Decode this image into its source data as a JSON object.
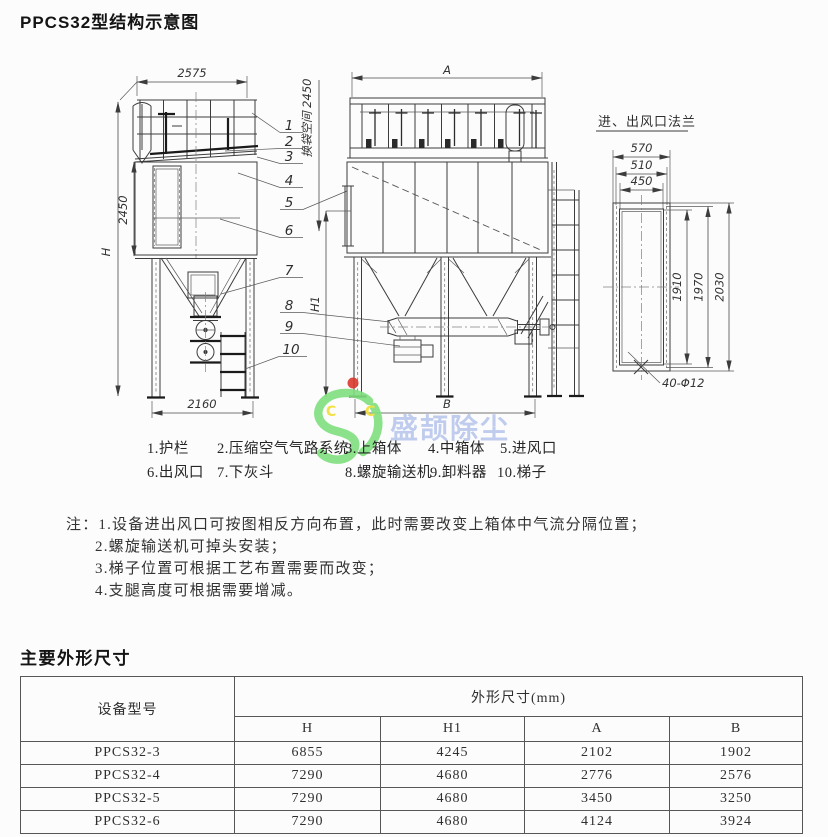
{
  "page": {
    "title": "PPCS32型结构示意图",
    "dims_section_title": "主要外形尺寸"
  },
  "diagram": {
    "side_view": {
      "width_top": "2575",
      "height_body": "2450",
      "height_total": "H",
      "width_base": "2160",
      "bag_space": "换袋空间 2450"
    },
    "front_view": {
      "width_top": "A",
      "width_base": "B",
      "height": "H1"
    },
    "flange_view": {
      "title": "进、出风口法兰",
      "w_outer": "570",
      "w_bolt": "510",
      "w_open": "450",
      "h_open": "1910",
      "h_bolt": "1970",
      "h_outer": "2030",
      "bolt_note": "40-Φ12"
    },
    "callouts": [
      "1",
      "2",
      "3",
      "4",
      "5",
      "6",
      "7",
      "8",
      "9",
      "10"
    ]
  },
  "legend": {
    "rows": [
      [
        "1.护栏",
        "2.压缩空气气路系统",
        "3.上箱体",
        "4.中箱体",
        "5.进风口"
      ],
      [
        "6.出风口",
        "7.下灰斗",
        "8.螺旋输送机",
        "9.卸料器",
        "10.梯子"
      ]
    ]
  },
  "notes": {
    "prefix": "注：",
    "lines": [
      "1.设备进出风口可按图相反方向布置，此时需要改变上箱体中气流分隔位置；",
      "2.螺旋输送机可掉头安装；",
      "3.梯子位置可根据工艺布置需要而改变；",
      "4.支腿高度可根据需要增减。"
    ]
  },
  "watermark": {
    "text": "盛颉除尘",
    "letters": "C C",
    "colors": {
      "green": "#7fe07f",
      "blue": "#a3b6e8",
      "yellow": "#f1de34",
      "red": "#da392c"
    }
  },
  "table": {
    "model_header": "设备型号",
    "group_header": "外形尺寸(mm)",
    "columns": [
      "H",
      "H1",
      "A",
      "B"
    ],
    "rows": [
      {
        "model": "PPCS32-3",
        "values": [
          "6855",
          "4245",
          "2102",
          "1902"
        ]
      },
      {
        "model": "PPCS32-4",
        "values": [
          "7290",
          "4680",
          "2776",
          "2576"
        ]
      },
      {
        "model": "PPCS32-5",
        "values": [
          "7290",
          "4680",
          "3450",
          "3250"
        ]
      },
      {
        "model": "PPCS32-6",
        "values": [
          "7290",
          "4680",
          "4124",
          "3924"
        ]
      }
    ]
  }
}
